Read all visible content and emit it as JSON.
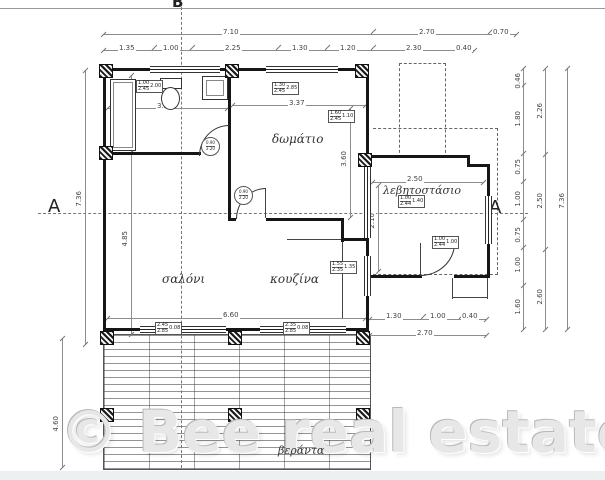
{
  "watermark": "© Bee real estate",
  "section_markers": {
    "b_top": "Β",
    "a_left": "A",
    "a_right": "A"
  },
  "rooms": {
    "bedroom": "δωμάτιο",
    "boiler": "λεβητοστάσιο",
    "living": "σαλόνι",
    "kitchen": "κουζίνα",
    "veranda": "βεράντα"
  },
  "dimensions": {
    "top_total": "7.10",
    "top_right": "2.70",
    "top_overhang": "0.70",
    "top_chain": [
      "1.35",
      "1.00",
      "2.25",
      "1.30",
      "1.20",
      "2.30",
      "0.40"
    ],
    "left_total": "7.36",
    "left_upper": "2.00",
    "left_lower": "4.85",
    "veranda_depth": "4.60",
    "bath_width": "3.23",
    "bedroom_width": "3.37",
    "bedroom_height": "3.60",
    "boiler_width": "2.50",
    "boiler_height": "2.10",
    "interior_width": "6.60",
    "bottom_right_chain": [
      "1.30",
      "1.00",
      "0.40"
    ],
    "bottom_right_total": "2.70",
    "right_chain": [
      "0.46",
      "1.80",
      "0.75",
      "1.00",
      "0.75",
      "1.00",
      "1.60"
    ],
    "right_mid_chain": [
      "2.26",
      "2.50",
      "2.60"
    ],
    "right_total": "7.36"
  },
  "tags": {
    "door_bath": {
      "top": "0.90",
      "bottom": "2.20"
    },
    "door_bedroom": {
      "top": "0.90",
      "bottom": "2.20"
    },
    "win_bath": {
      "top": "1.00",
      "bottom": "2.45",
      "side": "2.00"
    },
    "win_bedroom_top": {
      "top": "1.30",
      "bottom": "2.45",
      "side": "2.85"
    },
    "win_bedroom_right": {
      "top": "1.60",
      "bottom": "2.45",
      "side": "1.10"
    },
    "win_boiler_top": {
      "top": "1.00",
      "bottom": "2.44",
      "side": "1.40"
    },
    "win_boiler_right": {
      "top": "1.00",
      "bottom": "2.44",
      "side": "1.00"
    },
    "win_kitchen_right": {
      "top": "1.55",
      "bottom": "2.35",
      "side": "1.35"
    },
    "win_living_bottom": {
      "top": "2.45",
      "bottom": "2.85",
      "side": "0.08"
    },
    "win_kitchen_bottom": {
      "top": "2.35",
      "bottom": "2.85",
      "side": "0.08"
    }
  },
  "colors": {
    "wall": "#161616",
    "dim_line": "#8d8d8d",
    "watermark": "#e7e7e7"
  }
}
